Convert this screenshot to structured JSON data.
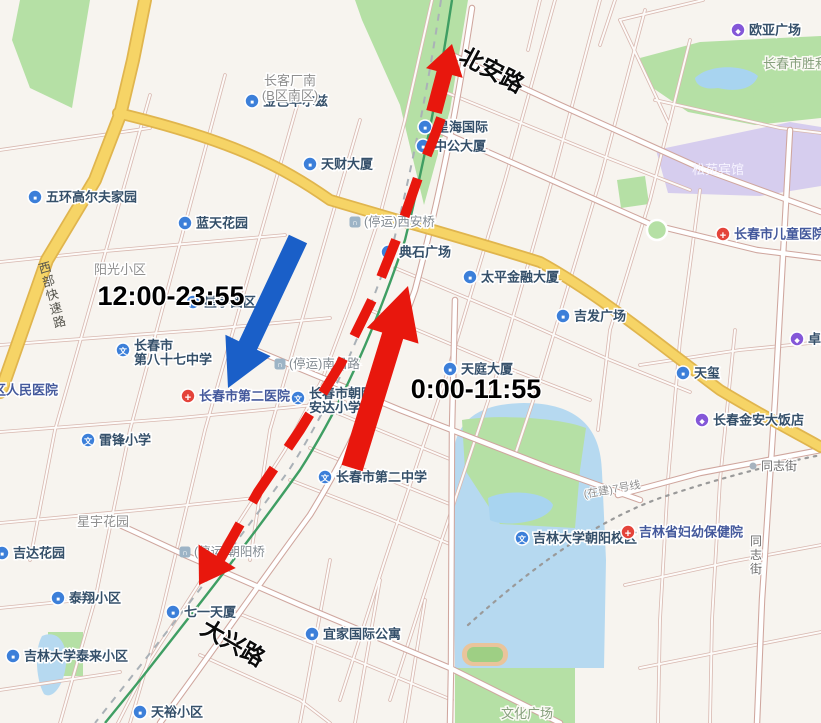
{
  "map": {
    "colors": {
      "annotation_red": "#e8170d",
      "annotation_blue": "#1a5fc8",
      "poi_blue": "#3c7fd9",
      "poi_red": "#e4433a",
      "poi_purple": "#8457d8",
      "bridge_gray": "#9db4c6",
      "road_yellow": "#f6d466",
      "park_green": "#b5e0a5",
      "water_blue": "#b6d9f0",
      "railway_green": "#3f9e63"
    },
    "labels": [
      {
        "id": "ouya-plaza",
        "type": "poi",
        "icon": "mall",
        "text": "欧亚广场",
        "x": 738,
        "y": 30
      },
      {
        "id": "shengli-park",
        "type": "park",
        "text": "长春市胜利",
        "x": 763,
        "y": 64,
        "anchor": "start"
      },
      {
        "id": "songyuan-hotel",
        "type": "white",
        "text": "松苑宾馆",
        "x": 718,
        "y": 170
      },
      {
        "id": "jinse-huaerzi",
        "type": "poi",
        "icon": "building",
        "text": "金色华尔兹",
        "x": 252,
        "y": 101
      },
      {
        "id": "xinghai-intl",
        "type": "poi",
        "icon": "building",
        "text": "星海国际",
        "x": 425,
        "y": 127
      },
      {
        "id": "changke-south",
        "type": "area",
        "lines": [
          "长客厂南",
          "(B区南区)"
        ],
        "x": 290,
        "y": 85
      },
      {
        "id": "tiancai-bldg",
        "type": "poi",
        "icon": "building",
        "text": "天财大厦",
        "x": 310,
        "y": 164
      },
      {
        "id": "zhonggong-bldg",
        "type": "poi",
        "icon": "building",
        "text": "中公大厦",
        "x": 423,
        "y": 146
      },
      {
        "id": "beian-road",
        "type": "roadbig",
        "text": "北安路",
        "x": 492,
        "y": 70,
        "rotate": 28
      },
      {
        "id": "wuhuan-golf",
        "type": "poi",
        "icon": "building",
        "text": "五环高尔夫家园",
        "x": 35,
        "y": 197
      },
      {
        "id": "lantian-garden",
        "type": "poi",
        "icon": "building",
        "text": "蓝天花园",
        "x": 185,
        "y": 223
      },
      {
        "id": "xian-bridge-closed",
        "type": "closed",
        "text": "(停运)西安桥",
        "x": 355,
        "y": 222
      },
      {
        "id": "dianshi-plaza",
        "type": "poi",
        "icon": "building",
        "text": "典石广场",
        "x": 388,
        "y": 252
      },
      {
        "id": "taiping-finance",
        "type": "poi",
        "icon": "building",
        "text": "太平金融大厦",
        "x": 470,
        "y": 277
      },
      {
        "id": "children-hospital",
        "type": "poi",
        "icon": "hospital",
        "text": "长春市儿童医院",
        "x": 723,
        "y": 234
      },
      {
        "id": "jifa-plaza",
        "type": "poi",
        "icon": "building",
        "text": "吉发广场",
        "x": 563,
        "y": 316
      },
      {
        "id": "zhuozhan",
        "type": "poi",
        "icon": "mall",
        "text": "卓展",
        "x": 797,
        "y": 339
      },
      {
        "id": "yangguang-community",
        "type": "area",
        "text": "阳光小区",
        "x": 120,
        "y": 270
      },
      {
        "id": "time-1200-2355",
        "type": "time",
        "text": "12:00-23:55",
        "x": 171,
        "y": 296
      },
      {
        "id": "xingyu-west",
        "type": "poi",
        "icon": "building",
        "text": "星宇西区",
        "x": 193,
        "y": 302
      },
      {
        "id": "western-expressway",
        "type": "roadvert",
        "text": "西部快速路",
        "x": 46,
        "y": 272,
        "rotate": -15
      },
      {
        "id": "school-87",
        "type": "poi",
        "icon": "school",
        "lines": [
          "长春市",
          "第八十七中学"
        ],
        "x": 123,
        "y": 350
      },
      {
        "id": "district-people-hospital",
        "type": "poi",
        "icon": "hospital",
        "text": "区人民医院",
        "x": -18,
        "y": 390
      },
      {
        "id": "second-hospital",
        "type": "poi",
        "icon": "hospital",
        "text": "长春市第二医院",
        "x": 188,
        "y": 396
      },
      {
        "id": "nanchang-road-closed",
        "type": "closed",
        "text": "(停运)南昌路",
        "x": 280,
        "y": 364
      },
      {
        "id": "anda-primary",
        "type": "poi",
        "icon": "school",
        "lines": [
          "长春市朝阳",
          "安达小学"
        ],
        "x": 298,
        "y": 398
      },
      {
        "id": "time-000-1155",
        "type": "time",
        "text": "0:00-11:55",
        "x": 476,
        "y": 389
      },
      {
        "id": "tianting-bldg",
        "type": "poi",
        "icon": "building",
        "text": "天庭大厦",
        "x": 450,
        "y": 369
      },
      {
        "id": "tianxi",
        "type": "poi",
        "icon": "building",
        "text": "天玺",
        "x": 683,
        "y": 373
      },
      {
        "id": "jinan-hotel",
        "type": "poi",
        "icon": "mall",
        "text": "长春金安大饭店",
        "x": 702,
        "y": 420
      },
      {
        "id": "leifeng-primary",
        "type": "poi",
        "icon": "school",
        "text": "雷锋小学",
        "x": 88,
        "y": 440
      },
      {
        "id": "no2-middle-school",
        "type": "poi",
        "icon": "school",
        "text": "长春市第二中学",
        "x": 325,
        "y": 477
      },
      {
        "id": "tongzhi-street",
        "type": "roadsmall",
        "text": "同志街",
        "x": 753,
        "y": 466
      },
      {
        "id": "metro-line",
        "type": "metro",
        "text": "(在建)7号线",
        "x": 612,
        "y": 489,
        "rotate": -10
      },
      {
        "id": "jlu-chaoyang",
        "type": "poi",
        "icon": "school",
        "text": "吉林大学朝阳校区",
        "x": 522,
        "y": 538
      },
      {
        "id": "maternity-hospital",
        "type": "poi",
        "icon": "hospital",
        "text": "吉林省妇幼保健院",
        "x": 628,
        "y": 532
      },
      {
        "id": "tongzhi-street-vertical",
        "type": "roadvert2",
        "text": "同志街",
        "x": 756,
        "y": 545
      },
      {
        "id": "xingyu-garden",
        "type": "area",
        "text": "星宇花园",
        "x": 103,
        "y": 522
      },
      {
        "id": "chaoyang-bridge-closed",
        "type": "closed",
        "text": "(停运)朝阳桥",
        "x": 185,
        "y": 552
      },
      {
        "id": "jida-garden",
        "type": "poi",
        "icon": "building",
        "text": "吉达花园",
        "x": 2,
        "y": 553
      },
      {
        "id": "taixiang-community",
        "type": "poi",
        "icon": "building",
        "text": "泰翔小区",
        "x": 58,
        "y": 598
      },
      {
        "id": "qiyi-bldg",
        "type": "poi",
        "icon": "building",
        "text": "七一天厦",
        "x": 173,
        "y": 612
      },
      {
        "id": "daxing-road",
        "type": "roadbig",
        "text": "大兴路",
        "x": 233,
        "y": 643,
        "rotate": 30
      },
      {
        "id": "jlu-tailai",
        "type": "poi",
        "icon": "building",
        "text": "吉林大学泰来小区",
        "x": 13,
        "y": 656
      },
      {
        "id": "tianyu-community",
        "type": "poi",
        "icon": "building",
        "text": "天裕小区",
        "x": 140,
        "y": 712
      },
      {
        "id": "yijia-intl",
        "type": "poi",
        "icon": "building",
        "text": "宜家国际公寓",
        "x": 312,
        "y": 634
      },
      {
        "id": "wenhua-square",
        "type": "park",
        "text": "文化广场",
        "x": 527,
        "y": 714
      }
    ],
    "annotations": {
      "arrows": [
        {
          "id": "red-main-arrow",
          "color": "annotation_red",
          "x1": 352,
          "y1": 468,
          "x2": 408,
          "y2": 286,
          "bw": 22,
          "hw": 54,
          "hl": 52,
          "time": "0:00-11:55"
        },
        {
          "id": "blue-main-arrow",
          "color": "annotation_blue",
          "x1": 298,
          "y1": 239,
          "x2": 228,
          "y2": 388,
          "bw": 20,
          "hw": 50,
          "hl": 47,
          "time": "12:00-23:55"
        },
        {
          "id": "red-top-arrow",
          "color": "annotation_red",
          "x1": 434,
          "y1": 112,
          "x2": 452,
          "y2": 44,
          "bw": 16,
          "hw": 38,
          "hl": 30
        }
      ],
      "dashed_route": {
        "id": "red-dashed-route",
        "color": "annotation_red",
        "width": 10,
        "dash": "40 25",
        "points": [
          [
            441,
            118
          ],
          [
            433,
            140
          ],
          [
            420,
            172
          ],
          [
            398,
            235
          ],
          [
            372,
            300
          ],
          [
            340,
            365
          ],
          [
            300,
            430
          ],
          [
            258,
            492
          ],
          [
            213,
            572
          ]
        ]
      },
      "dashed_arrowhead": {
        "id": "red-route-south-arrowhead",
        "color": "annotation_red",
        "tip": [
          199,
          585
        ],
        "dir": [
          -46,
          73
        ],
        "len": 34,
        "hw": 44
      }
    }
  }
}
